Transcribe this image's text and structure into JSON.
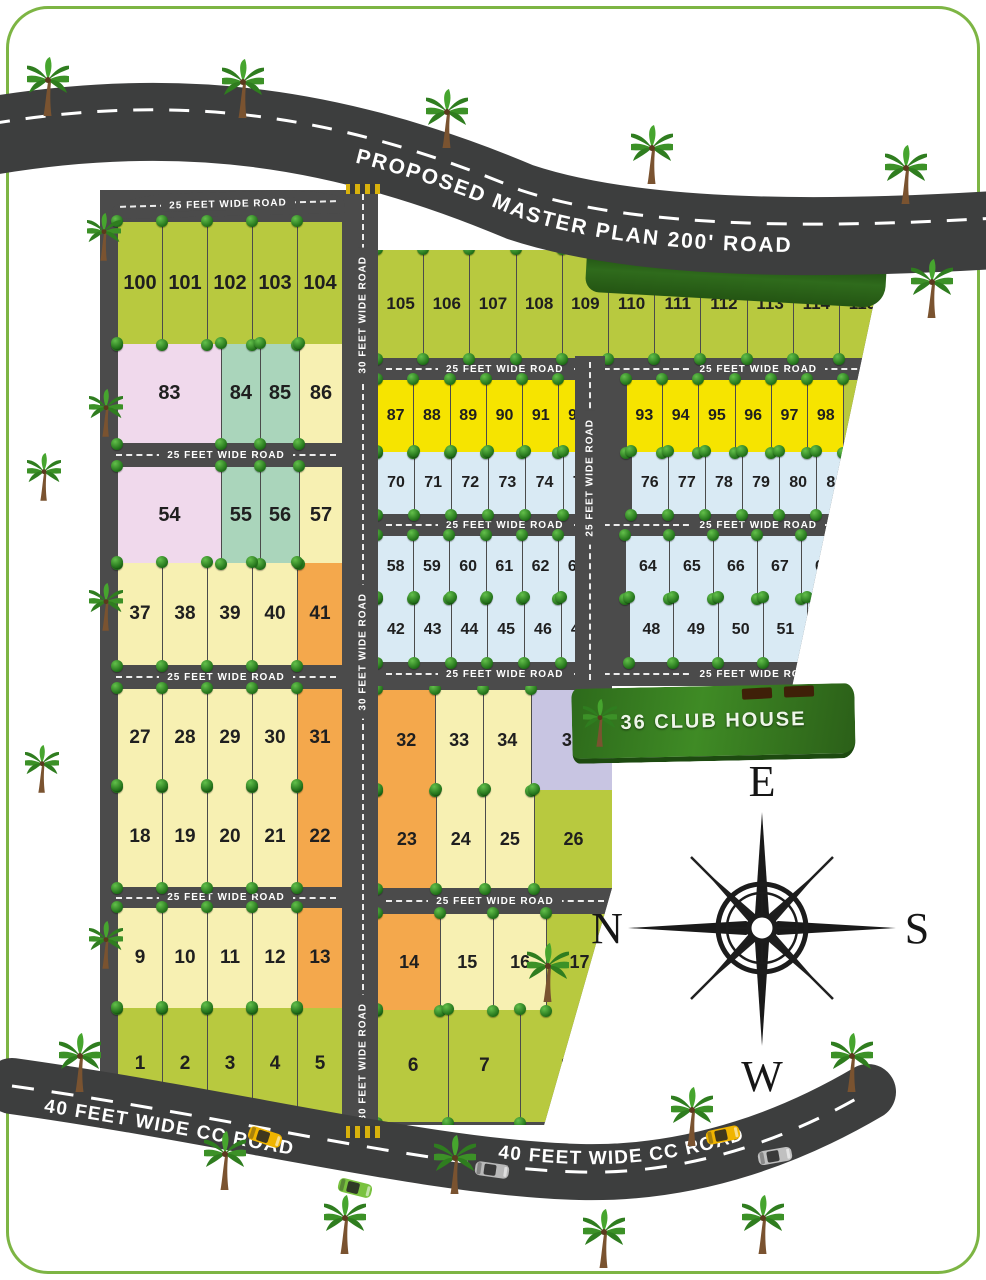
{
  "roads": {
    "master": "PROPOSED MASTER PLAN 200' ROAD",
    "r25": "25 FEET WIDE ROAD",
    "r30": "30 FEET WIDE ROAD",
    "r40": "40 FEET WIDE CC ROAD"
  },
  "clubhouse": {
    "label": "36 CLUB HOUSE"
  },
  "compass": {
    "top": "E",
    "left": "N",
    "right": "S",
    "bottom": "W"
  },
  "colors": {
    "green": "#b8c93f",
    "cream": "#f7f0b2",
    "orange": "#f4a84c",
    "pink": "#f0d9ec",
    "teal": "#aad5bb",
    "yellow": "#f6e400",
    "blue": "#d9eaf4",
    "lavender": "#c8c5e2",
    "road": "#4b4b4b",
    "border": "#7db544"
  },
  "blocks": {
    "left": {
      "rows": [
        {
          "plots": [
            {
              "n": "100",
              "c": "green"
            },
            {
              "n": "101",
              "c": "green"
            },
            {
              "n": "102",
              "c": "green"
            },
            {
              "n": "103",
              "c": "green"
            },
            {
              "n": "104",
              "c": "green"
            }
          ]
        },
        {
          "plots": [
            {
              "n": "83",
              "c": "pink",
              "w": 2.7
            },
            {
              "n": "84",
              "c": "teal"
            },
            {
              "n": "85",
              "c": "teal"
            },
            {
              "n": "86",
              "c": "cream",
              "w": 1.1
            }
          ]
        },
        {
          "plots": [
            {
              "n": "54",
              "c": "pink",
              "w": 2.7
            },
            {
              "n": "55",
              "c": "teal"
            },
            {
              "n": "56",
              "c": "teal"
            },
            {
              "n": "57",
              "c": "cream",
              "w": 1.1
            }
          ]
        },
        {
          "plots": [
            {
              "n": "37",
              "c": "cream"
            },
            {
              "n": "38",
              "c": "cream"
            },
            {
              "n": "39",
              "c": "cream"
            },
            {
              "n": "40",
              "c": "cream"
            },
            {
              "n": "41",
              "c": "orange"
            }
          ]
        },
        {
          "plots": [
            {
              "n": "27",
              "c": "cream"
            },
            {
              "n": "28",
              "c": "cream"
            },
            {
              "n": "29",
              "c": "cream"
            },
            {
              "n": "30",
              "c": "cream"
            },
            {
              "n": "31",
              "c": "orange"
            }
          ]
        },
        {
          "plots": [
            {
              "n": "18",
              "c": "cream"
            },
            {
              "n": "19",
              "c": "cream"
            },
            {
              "n": "20",
              "c": "cream"
            },
            {
              "n": "21",
              "c": "cream"
            },
            {
              "n": "22",
              "c": "orange"
            }
          ]
        },
        {
          "plots": [
            {
              "n": "9",
              "c": "cream"
            },
            {
              "n": "10",
              "c": "cream"
            },
            {
              "n": "11",
              "c": "cream"
            },
            {
              "n": "12",
              "c": "cream"
            },
            {
              "n": "13",
              "c": "orange"
            }
          ]
        },
        {
          "plots": [
            {
              "n": "1",
              "c": "green"
            },
            {
              "n": "2",
              "c": "green"
            },
            {
              "n": "3",
              "c": "green"
            },
            {
              "n": "4",
              "c": "green"
            },
            {
              "n": "5",
              "c": "green"
            }
          ]
        }
      ]
    },
    "right_upper": {
      "rows": [
        {
          "plots": [
            {
              "n": "105",
              "c": "green"
            },
            {
              "n": "106",
              "c": "green"
            },
            {
              "n": "107",
              "c": "green"
            },
            {
              "n": "108",
              "c": "green"
            },
            {
              "n": "109",
              "c": "green"
            },
            {
              "n": "110",
              "c": "green"
            },
            {
              "n": "111",
              "c": "green"
            },
            {
              "n": "112",
              "c": "green"
            },
            {
              "n": "113",
              "c": "green"
            },
            {
              "n": "114",
              "c": "green"
            },
            {
              "n": "115",
              "c": "green"
            }
          ]
        },
        {
          "plots": [
            {
              "n": "87",
              "c": "yellow"
            },
            {
              "n": "88",
              "c": "yellow"
            },
            {
              "n": "89",
              "c": "yellow"
            },
            {
              "n": "90",
              "c": "yellow"
            },
            {
              "n": "91",
              "c": "yellow"
            },
            {
              "n": "92",
              "c": "yellow"
            },
            {
              "gap": 30
            },
            {
              "n": "93",
              "c": "yellow"
            },
            {
              "n": "94",
              "c": "yellow"
            },
            {
              "n": "95",
              "c": "yellow"
            },
            {
              "n": "96",
              "c": "yellow"
            },
            {
              "n": "97",
              "c": "yellow"
            },
            {
              "n": "98",
              "c": "yellow"
            },
            {
              "n": "99",
              "c": "green",
              "w": 1.15
            }
          ]
        },
        {
          "plots": [
            {
              "n": "70",
              "c": "blue"
            },
            {
              "n": "71",
              "c": "blue"
            },
            {
              "n": "72",
              "c": "blue"
            },
            {
              "n": "73",
              "c": "blue"
            },
            {
              "n": "74",
              "c": "blue"
            },
            {
              "n": "75",
              "c": "blue"
            },
            {
              "gap": 30
            },
            {
              "n": "76",
              "c": "blue"
            },
            {
              "n": "77",
              "c": "blue"
            },
            {
              "n": "78",
              "c": "blue"
            },
            {
              "n": "79",
              "c": "blue"
            },
            {
              "n": "80",
              "c": "blue"
            },
            {
              "n": "81",
              "c": "blue"
            },
            {
              "n": "82",
              "c": "green",
              "w": 0.85
            }
          ]
        },
        {
          "plots": [
            {
              "n": "58",
              "c": "blue"
            },
            {
              "n": "59",
              "c": "blue"
            },
            {
              "n": "60",
              "c": "blue"
            },
            {
              "n": "61",
              "c": "blue"
            },
            {
              "n": "62",
              "c": "blue"
            },
            {
              "n": "63",
              "c": "blue"
            },
            {
              "gap": 30
            },
            {
              "n": "64",
              "c": "blue",
              "w": 1.22
            },
            {
              "n": "65",
              "c": "blue",
              "w": 1.22
            },
            {
              "n": "66",
              "c": "blue",
              "w": 1.22
            },
            {
              "n": "67",
              "c": "blue",
              "w": 1.22
            },
            {
              "n": "68",
              "c": "blue",
              "w": 1.22
            },
            {
              "n": "69",
              "c": "green",
              "w": 1.1
            }
          ]
        },
        {
          "plots": [
            {
              "n": "42",
              "c": "blue"
            },
            {
              "n": "43",
              "c": "blue"
            },
            {
              "n": "44",
              "c": "blue"
            },
            {
              "n": "45",
              "c": "blue"
            },
            {
              "n": "46",
              "c": "blue"
            },
            {
              "n": "47",
              "c": "blue"
            },
            {
              "gap": 30
            },
            {
              "n": "48",
              "c": "blue",
              "w": 1.22
            },
            {
              "n": "49",
              "c": "blue",
              "w": 1.22
            },
            {
              "n": "50",
              "c": "blue",
              "w": 1.22
            },
            {
              "n": "51",
              "c": "blue",
              "w": 1.22
            },
            {
              "n": "52",
              "c": "blue",
              "w": 1.22
            },
            {
              "n": "53",
              "c": "green",
              "w": 0.9
            }
          ]
        }
      ]
    },
    "right_lower": {
      "rows": [
        {
          "plots": [
            {
              "n": "32",
              "c": "orange",
              "w": 1.2
            },
            {
              "n": "33",
              "c": "cream"
            },
            {
              "n": "34",
              "c": "cream"
            },
            {
              "n": "35",
              "c": "lavender",
              "w": 1.7
            }
          ]
        },
        {
          "plots": [
            {
              "n": "23",
              "c": "orange",
              "w": 1.2
            },
            {
              "n": "24",
              "c": "cream"
            },
            {
              "n": "25",
              "c": "cream"
            },
            {
              "n": "26",
              "c": "green",
              "w": 1.6
            }
          ]
        },
        {
          "plots": [
            {
              "n": "14",
              "c": "orange",
              "w": 1.2
            },
            {
              "n": "15",
              "c": "cream"
            },
            {
              "n": "16",
              "c": "cream"
            },
            {
              "n": "17",
              "c": "green",
              "w": 1.25
            }
          ]
        },
        {
          "plots": [
            {
              "n": "6",
              "c": "green"
            },
            {
              "n": "7",
              "c": "green"
            },
            {
              "n": "8",
              "c": "green",
              "w": 1.3
            }
          ]
        }
      ]
    }
  }
}
